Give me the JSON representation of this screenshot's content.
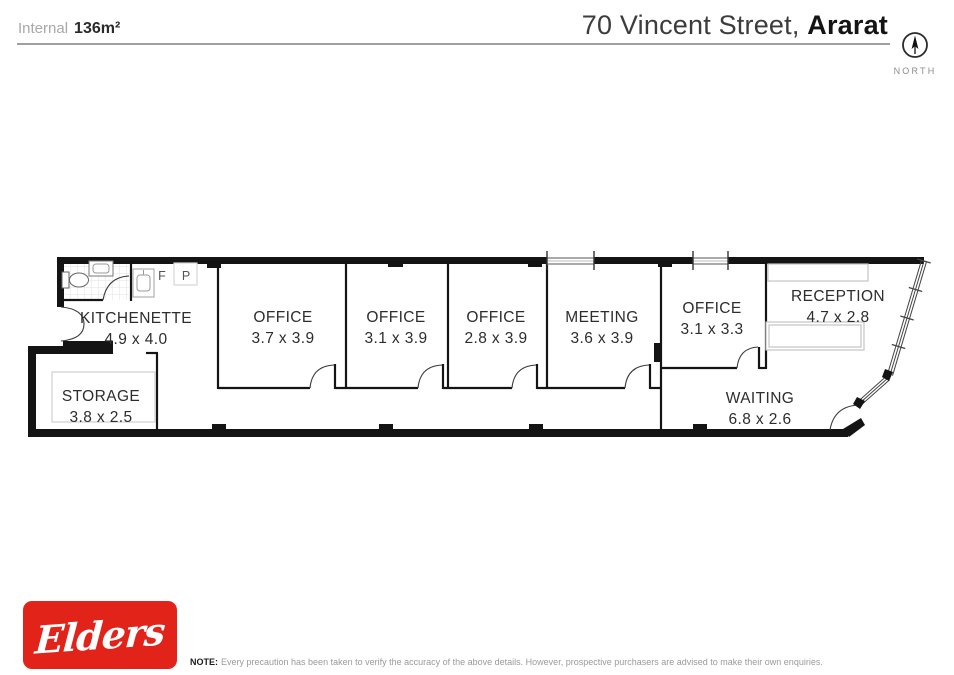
{
  "header": {
    "area_label": "Internal",
    "area_value": "136m²",
    "address_light": "70 Vincent Street,",
    "address_bold": "Ararat",
    "north_label": "NORTH"
  },
  "plan": {
    "rooms": [
      {
        "id": "kitchenette",
        "name": "KITCHENETTE",
        "dims": "4.9 x 4.0"
      },
      {
        "id": "storage",
        "name": "STORAGE",
        "dims": "3.8 x 2.5"
      },
      {
        "id": "office-1",
        "name": "OFFICE",
        "dims": "3.7 x 3.9"
      },
      {
        "id": "office-2",
        "name": "OFFICE",
        "dims": "3.1 x 3.9"
      },
      {
        "id": "office-3",
        "name": "OFFICE",
        "dims": "2.8 x 3.9"
      },
      {
        "id": "meeting",
        "name": "MEETING",
        "dims": "3.6 x 3.9"
      },
      {
        "id": "office-4",
        "name": "OFFICE",
        "dims": "3.1 x 3.3"
      },
      {
        "id": "reception",
        "name": "RECEPTION",
        "dims": "4.7 x 2.8"
      },
      {
        "id": "waiting",
        "name": "WAITING",
        "dims": "6.8 x 2.6"
      }
    ],
    "fixtures": {
      "fridge_label": "F",
      "pantry_label": "P"
    }
  },
  "footer": {
    "brand": "Elders",
    "note_label": "NOTE:",
    "note_text": "Every precaution has been taken to verify the accuracy of the above details. However, prospective purchasers are advised to make their own enquiries."
  },
  "colors": {
    "brand_red": "#E2231A",
    "wall_black": "#141414",
    "rule_gray": "#a0a0a0",
    "label_gray": "#2d2d2d",
    "muted_gray": "#9a9a9a"
  }
}
